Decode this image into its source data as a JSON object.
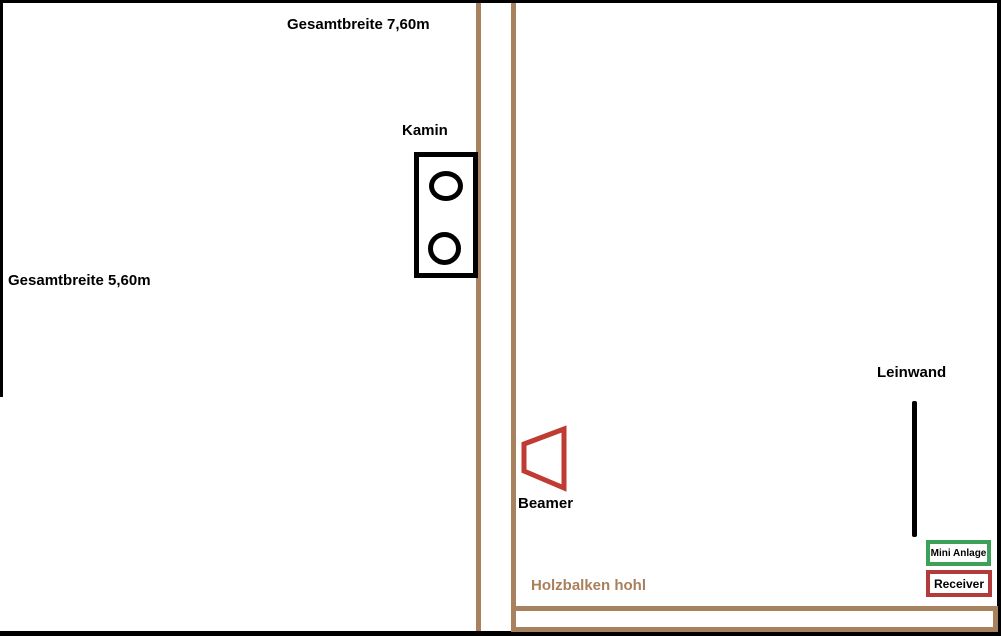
{
  "diagram": {
    "type": "floor-plan-sketch",
    "labels": {
      "total_width_top": "Gesamtbreite 7,60m",
      "total_width_left": "Gesamtbreite 5,60m",
      "kamin": "Kamin",
      "leinwand": "Leinwand",
      "beamer": "Beamer",
      "holzbalken": "Holzbalken hohl",
      "mini_anlage": "Mini Anlage",
      "receiver": "Receiver"
    },
    "colors": {
      "wall_brown": "#A8815F",
      "holzbalken_text_brown": "#A9805C",
      "beamer_red": "#C03B31",
      "receiver_border_red": "#B23B3B",
      "mini_anlage_border_green": "#3EA159",
      "outline_black": "#000000",
      "background": "#FFFFFF"
    }
  }
}
